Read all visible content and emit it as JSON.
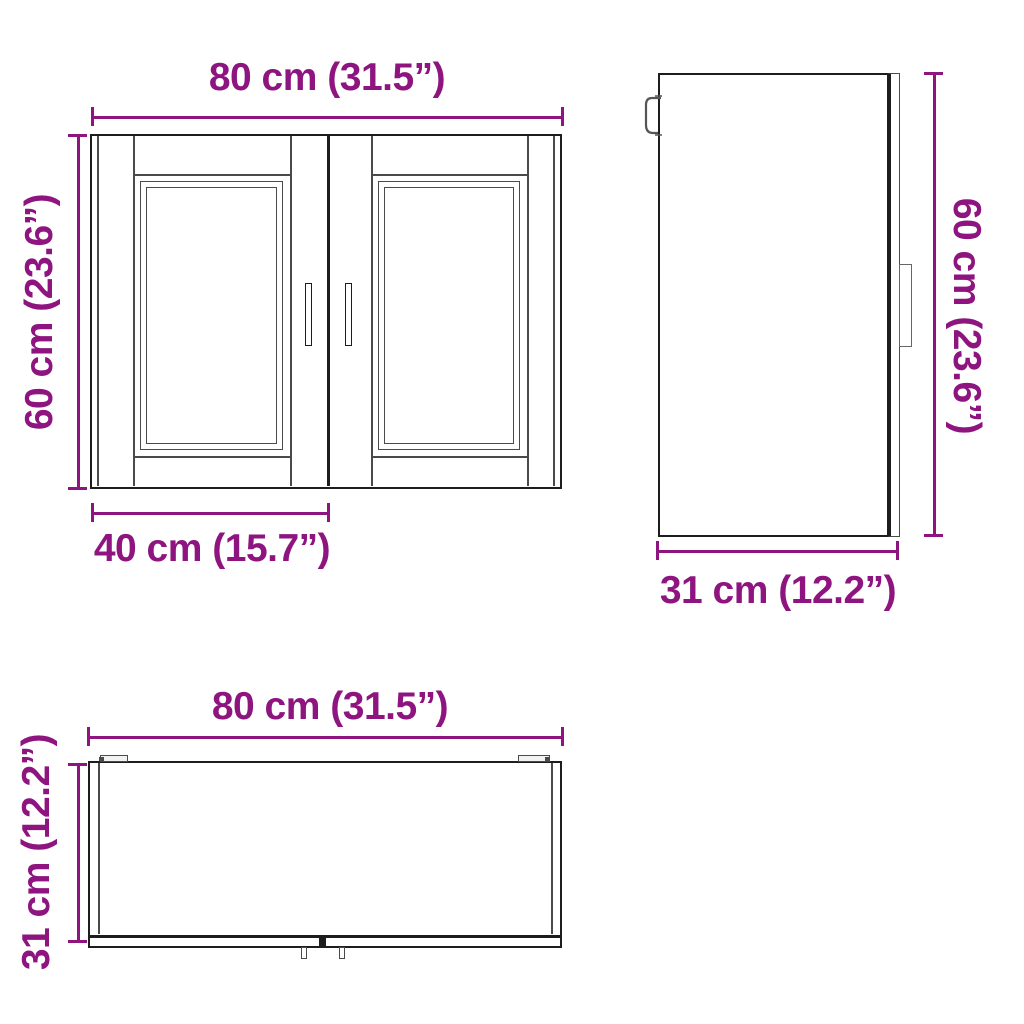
{
  "colors": {
    "accent": "#8E1480",
    "line_dark": "#1d1d1d",
    "line_light": "#4a4a4a",
    "background": "#ffffff"
  },
  "front_view": {
    "width_label": "80 cm (31.5”)",
    "height_label": "60 cm (23.6”)",
    "door_width_label": "40 cm (15.7”)"
  },
  "side_view": {
    "height_label": "60 cm (23.6”)",
    "depth_label": "31 cm (12.2”)"
  },
  "top_view": {
    "width_label": "80 cm (31.5”)",
    "depth_label": "31 cm (12.2”)"
  }
}
